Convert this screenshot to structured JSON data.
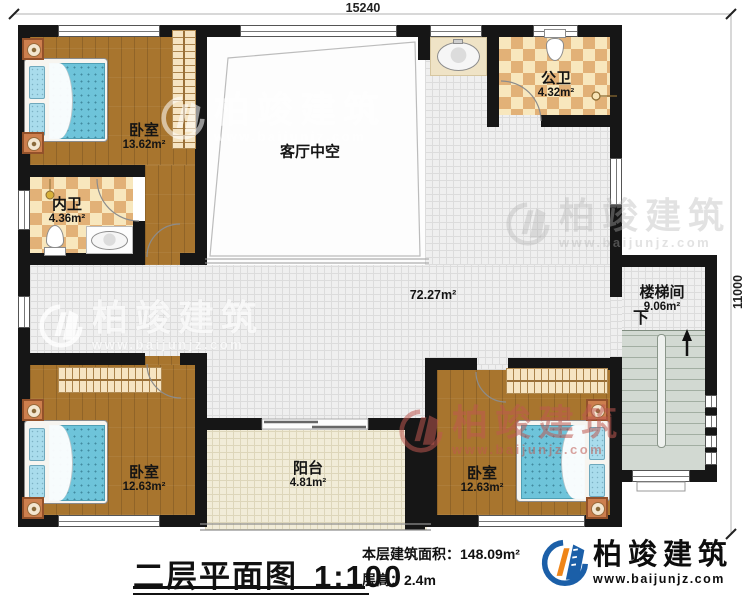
{
  "dimensions": {
    "top": "15240",
    "right": "11000"
  },
  "rooms": {
    "bedroom_tl": {
      "name": "卧室",
      "area": "13.62m²"
    },
    "inner_bath": {
      "name": "内卫",
      "area": "4.36m²"
    },
    "living_void": {
      "name": "客厅中空"
    },
    "public_bath": {
      "name": "公卫",
      "area": "4.32m²"
    },
    "corridor": {
      "area": "72.27m²"
    },
    "stairwell": {
      "name": "楼梯间",
      "area": "9.06m²",
      "down_label": "下"
    },
    "bedroom_bl": {
      "name": "卧室",
      "area": "12.63m²"
    },
    "balcony": {
      "name": "阳台",
      "area": "4.81m²"
    },
    "bedroom_br": {
      "name": "卧室",
      "area": "12.63m²"
    }
  },
  "footer": {
    "title": "二层平面图",
    "scale": "1:100",
    "area_label": "本层建筑面积：",
    "area_value": "148.09m²",
    "height_label": "层高：",
    "height_value": "2.4m"
  },
  "brand": {
    "name": "柏竣建筑",
    "url": "www.baijunjz.com"
  },
  "watermark": {
    "text": "柏竣建筑",
    "url": "www.baijunjz.com"
  },
  "colors": {
    "wall": "#161616",
    "wood": "#a8752e",
    "tile_light": "#f8e7bd",
    "tile_dark": "#e2b177",
    "corridor": "#efefef",
    "balcony": "#f1ecd8",
    "stairs": "#d2d9d2",
    "bed_blue": "#6ec4da",
    "nightstand": "#cd7f4e",
    "wardrobe": "#f6e4c2",
    "brand_blue": "#1b5fa8",
    "brand_orange": "#ef8518"
  }
}
